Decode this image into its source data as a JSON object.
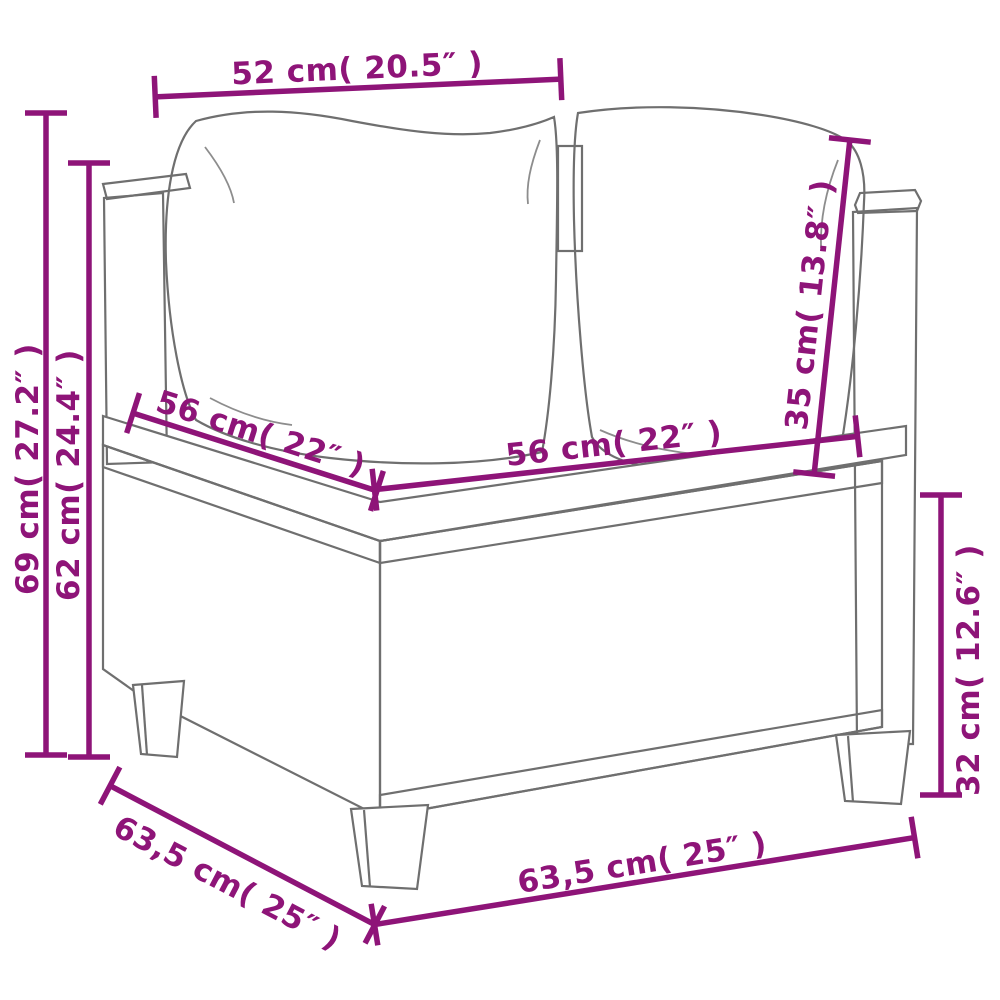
{
  "diagram": {
    "type": "product-dimension-diagram",
    "subject": "poly rattan corner sofa section with back cushions and seat cushion",
    "accent_color": "#8E1478",
    "sketch_color": "#6f6f6f"
  },
  "dimensions": {
    "top_back_width": "52 cm( 20.5″ )",
    "overall_height": "69 cm( 27.2″ )",
    "backrest_height": "62 cm( 24.4″ )",
    "seat_depth": "56 cm( 22″ )",
    "seat_width": "56 cm( 22″ )",
    "back_cushion_height": "35 cm( 13.8″ )",
    "base_height": "32 cm( 12.6″ )",
    "overall_depth": "63,5 cm( 25″ )",
    "overall_width": "63,5 cm( 25″ )"
  }
}
